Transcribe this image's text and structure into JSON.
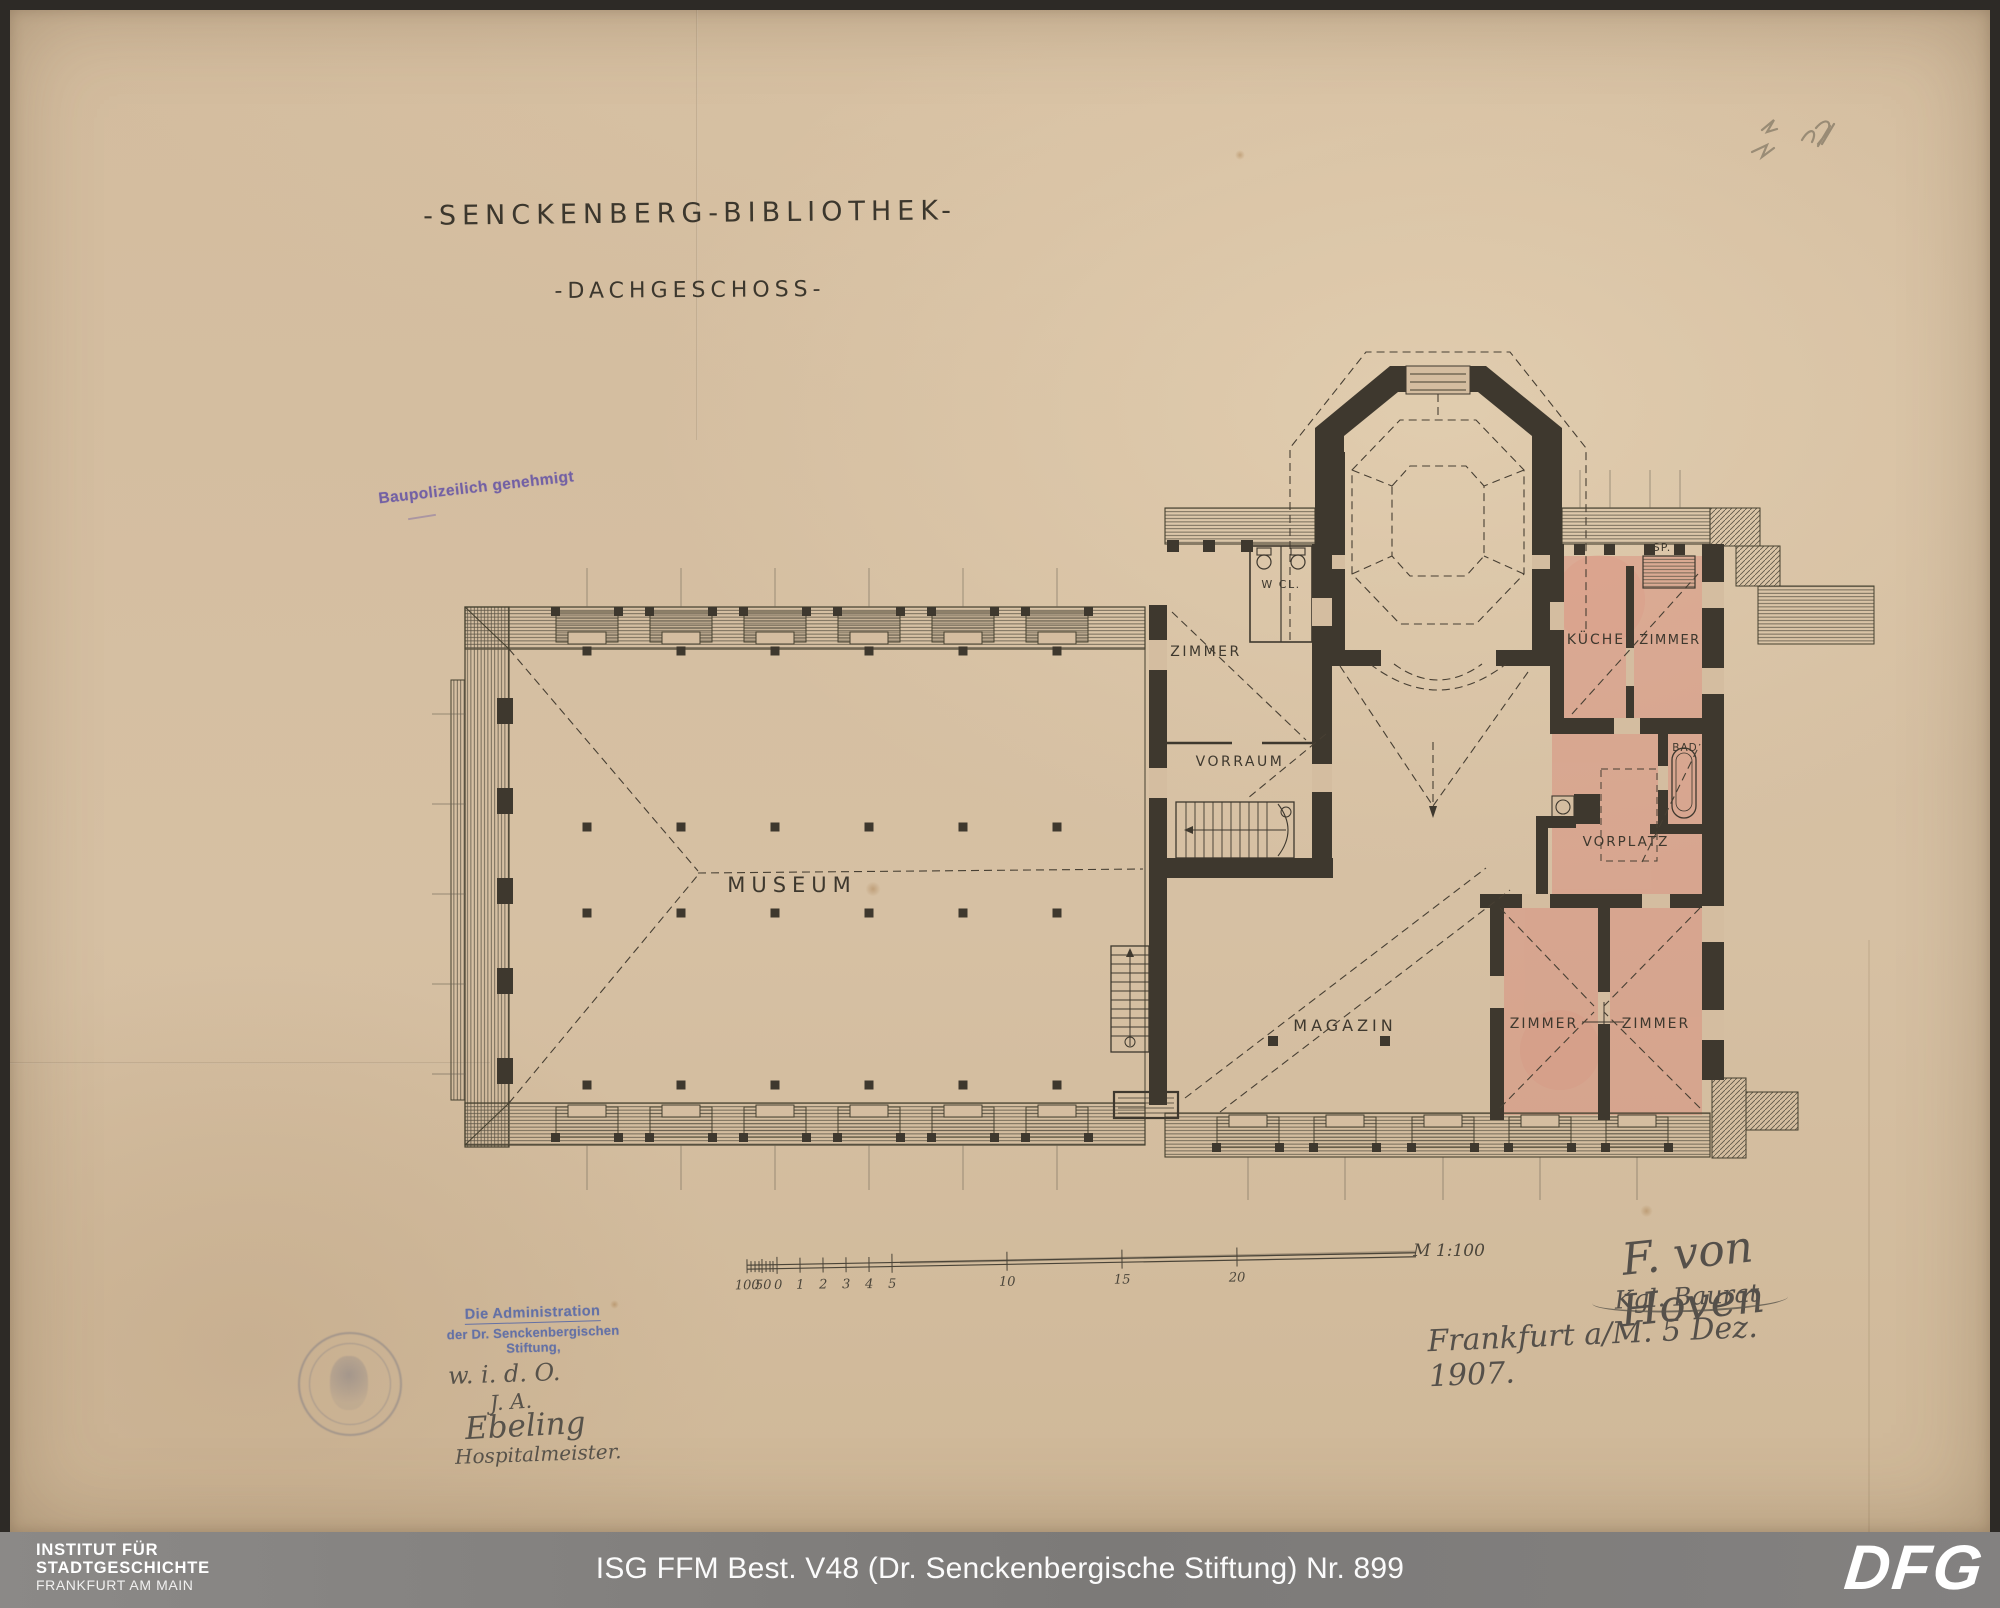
{
  "sheet": {
    "title": "-SENCKENBERG-BIBLIOTHEK-",
    "subtitle": "-DACHGESCHOSS-",
    "approval_stamp": "Baupolizeilich genehmigt",
    "rooms": {
      "museum": "MUSEUM",
      "magazin": "MAGAZIN",
      "vorraum": "VORRAUM",
      "zimmer_nw": "ZIMMER",
      "wc": "W CL.",
      "sp": "SP.",
      "kueche": "KÜCHE",
      "zimmer_ne": "ZIMMER",
      "bad": "BAD",
      "vorplatz": "VORPLATZ",
      "zimmer_s1": "ZIMMER",
      "zimmer_s2": "ZIMMER"
    },
    "scale": {
      "label": "M 1:100",
      "ticks": [
        "100",
        "50",
        "0",
        "1",
        "2",
        "3",
        "4",
        "5",
        "10",
        "15",
        "20"
      ]
    },
    "signature": {
      "name": "F. von Hoven",
      "title": "Kgl. Baurat",
      "place_date": "Frankfurt a/M. 5 Dez. 1907."
    },
    "admin_stamp": {
      "line1": "Die Administration",
      "line2": "der Dr. Senckenbergischen Stiftung,",
      "note1": "w. i. d. O.",
      "note2": "J. A.",
      "note3": "Ebeling",
      "note4": "Hospitalmeister."
    }
  },
  "footer": {
    "institute_line1": "INSTITUT FÜR",
    "institute_line2": "STADTGESCHICHTE",
    "institute_line3": "FRANKFURT AM MAIN",
    "caption": "ISG FFM Best. V48 (Dr. Senckenbergische Stiftung) Nr. 899",
    "dfg": "DFG"
  },
  "colors": {
    "paper": "#d4bda0",
    "ink": "#3e382e",
    "room_tint_pink": "#d97f73",
    "approval_stamp_purple": "#6b5aa5",
    "admin_stamp_blue": "#5668a8",
    "footer_gray": "#807d7a"
  }
}
